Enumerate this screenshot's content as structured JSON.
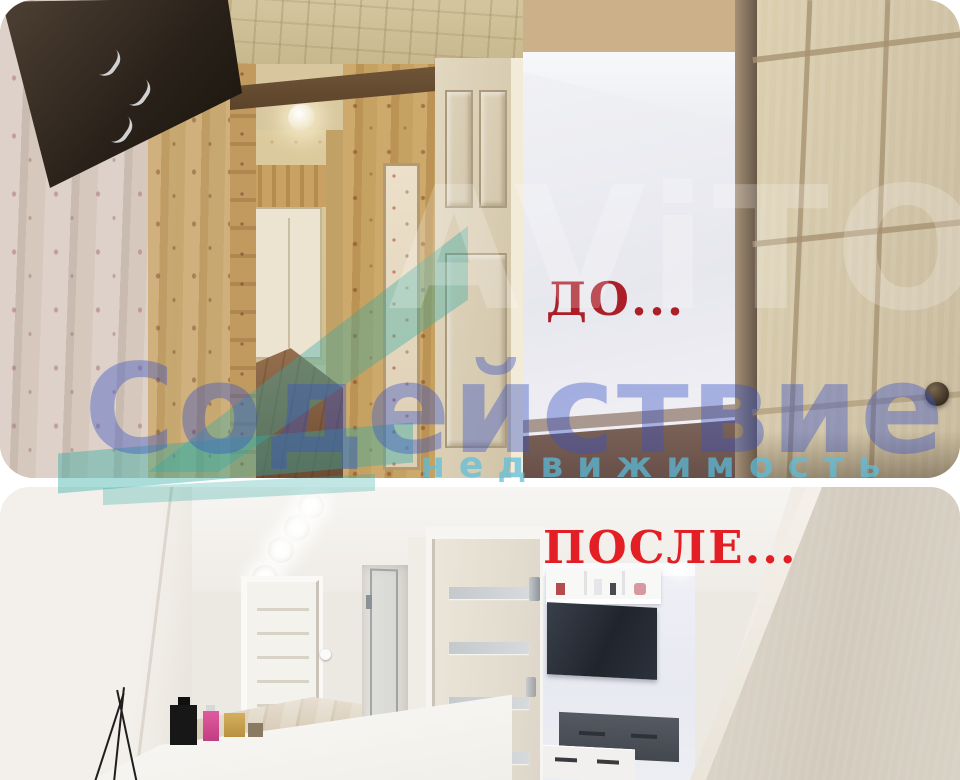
{
  "collage": {
    "before_label": "ДО...",
    "after_label": "ПОСЛЕ...",
    "watermark": {
      "brand": "AViTO",
      "agency": "Содействие",
      "tagline": "недвижимость"
    },
    "colors": {
      "before_label": "#ab2028",
      "after_label": "#e31e24",
      "watermark_brand": "rgba(255,255,255,0.21)",
      "watermark_agency": "rgba(56,82,198,0.40)",
      "watermark_tagline": "rgba(92,190,220,0.72)",
      "watermark_logo_accent": "rgba(52,172,164,0.40)",
      "page_background": "#ffffff"
    }
  }
}
